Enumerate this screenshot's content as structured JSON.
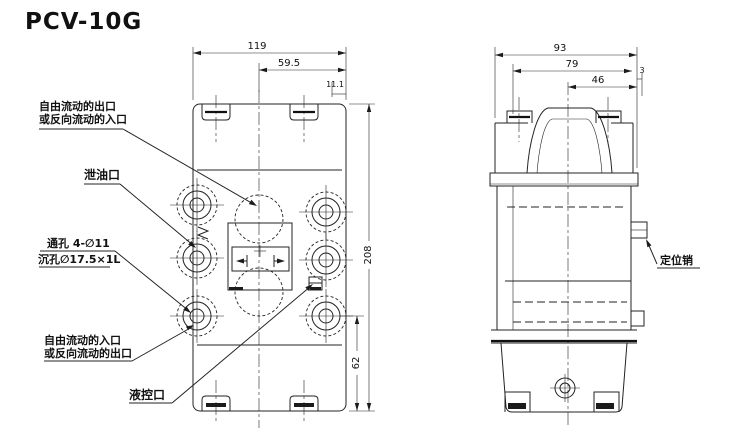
{
  "title": "PCV-10G",
  "labels": {
    "outlet_free_line1": "自由流动的出口",
    "outlet_free_line2": "或反向流动的入口",
    "drain": "泄油口",
    "through_hole": "通孔 4-∅11",
    "counterbore": "沉孔∅17.5×1L",
    "inlet_free_line1": "自由流动的入口",
    "inlet_free_line2": "或反向流动的出口",
    "pilot": "液控口",
    "locating_pin": "定位销"
  },
  "dimensions": {
    "front": {
      "overall_width": "119",
      "center_to_edge": "59.5",
      "top_offset": "11.1",
      "overall_height": "208",
      "port_height": "62"
    },
    "side": {
      "overall_width": "93",
      "body_width": "79",
      "center_to_edge": "46",
      "pin_offset": "3"
    }
  },
  "colors": {
    "ink": "#232323",
    "paper": "#ffffff"
  }
}
